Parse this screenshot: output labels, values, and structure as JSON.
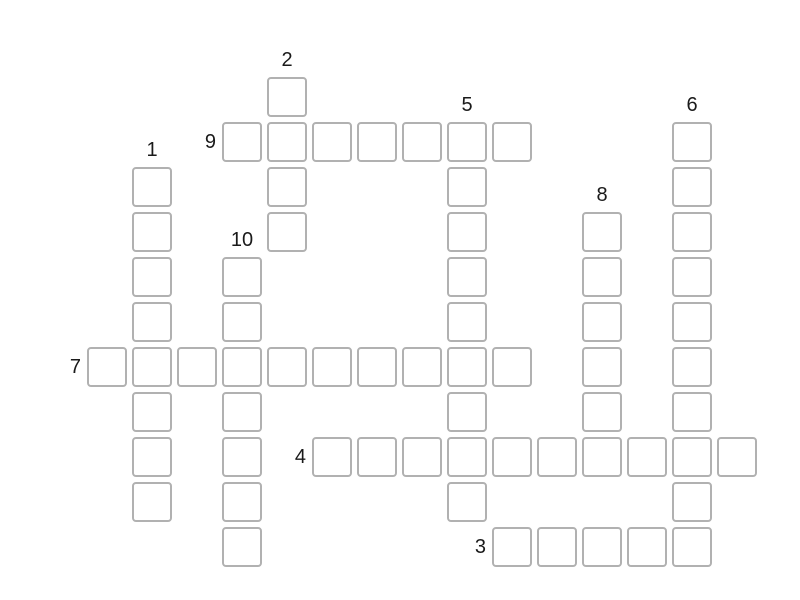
{
  "page": {
    "background_color": "#ffffff",
    "cell_border_color": "#b1b1b1",
    "cell_fill_color": "#ffffff",
    "number_color": "#1a1a1a"
  },
  "puzzle": {
    "type": "crossword-grid",
    "all_cells_empty": true,
    "entries": [
      {
        "number": "9",
        "direction": "across",
        "row": 1,
        "col": 3,
        "length": 7
      },
      {
        "number": "7",
        "direction": "across",
        "row": 6,
        "col": 0,
        "length": 10
      },
      {
        "number": "4",
        "direction": "across",
        "row": 8,
        "col": 5,
        "length": 10
      },
      {
        "number": "3",
        "direction": "across",
        "row": 10,
        "col": 9,
        "length": 5
      },
      {
        "number": "1",
        "direction": "down",
        "row": 2,
        "col": 1,
        "length": 8
      },
      {
        "number": "2",
        "direction": "down",
        "row": 0,
        "col": 4,
        "length": 4
      },
      {
        "number": "5",
        "direction": "down",
        "row": 1,
        "col": 8,
        "length": 9
      },
      {
        "number": "6",
        "direction": "down",
        "row": 1,
        "col": 13,
        "length": 10
      },
      {
        "number": "8",
        "direction": "down",
        "row": 3,
        "col": 11,
        "length": 6
      },
      {
        "number": "10",
        "direction": "down",
        "row": 4,
        "col": 3,
        "length": 7
      }
    ]
  }
}
